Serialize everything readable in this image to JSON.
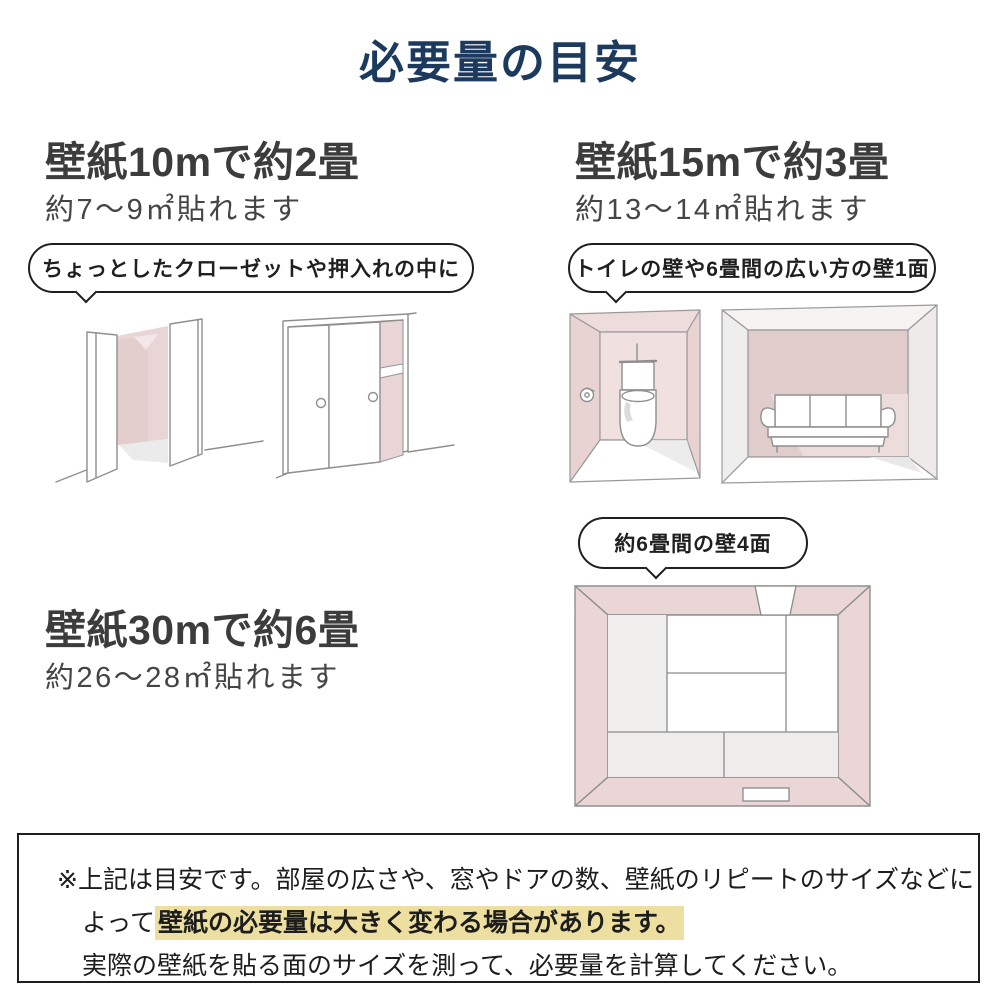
{
  "title": "必要量の目安",
  "sections": {
    "ten_m": {
      "heading": "壁紙10mで約2畳",
      "subheading": "約7〜9㎡貼れます",
      "bubble": "ちょっとしたクローゼットや押入れの中に"
    },
    "fifteen_m": {
      "heading": "壁紙15mで約3畳",
      "subheading": "約13〜14㎡貼れます",
      "bubble": "トイレの壁や6畳間の広い方の壁1面"
    },
    "thirty_m": {
      "heading": "壁紙30mで約6畳",
      "subheading": "約26〜28㎡貼れます",
      "bubble": "約6畳間の壁4面"
    }
  },
  "footer": {
    "line1": "※上記は目安です。部屋の広さや、窓やドアの数、壁紙のリピートのサイズなどに",
    "line2_prefix": "よって",
    "line2_highlight": "壁紙の必要量は大きく変わる場合があります。",
    "line3": "実際の壁紙を貼る面のサイズを測って、必要量を計算してください。"
  },
  "illustration_names": [
    "closet-open-illustration",
    "closet-sliding-illustration",
    "toilet-room-illustration",
    "sofa-room-illustration",
    "room-top-view-illustration"
  ],
  "colors": {
    "title_navy": "#1c3a5e",
    "heading_gray": "#3c3c3c",
    "wall_pink": "#e9d5d5",
    "wall_pink_dark": "#e0c9c9",
    "highlight_yellow": "#ecdf9f",
    "border_black": "#1f1f1f",
    "sketch_line_gray": "#8f8f8f"
  }
}
